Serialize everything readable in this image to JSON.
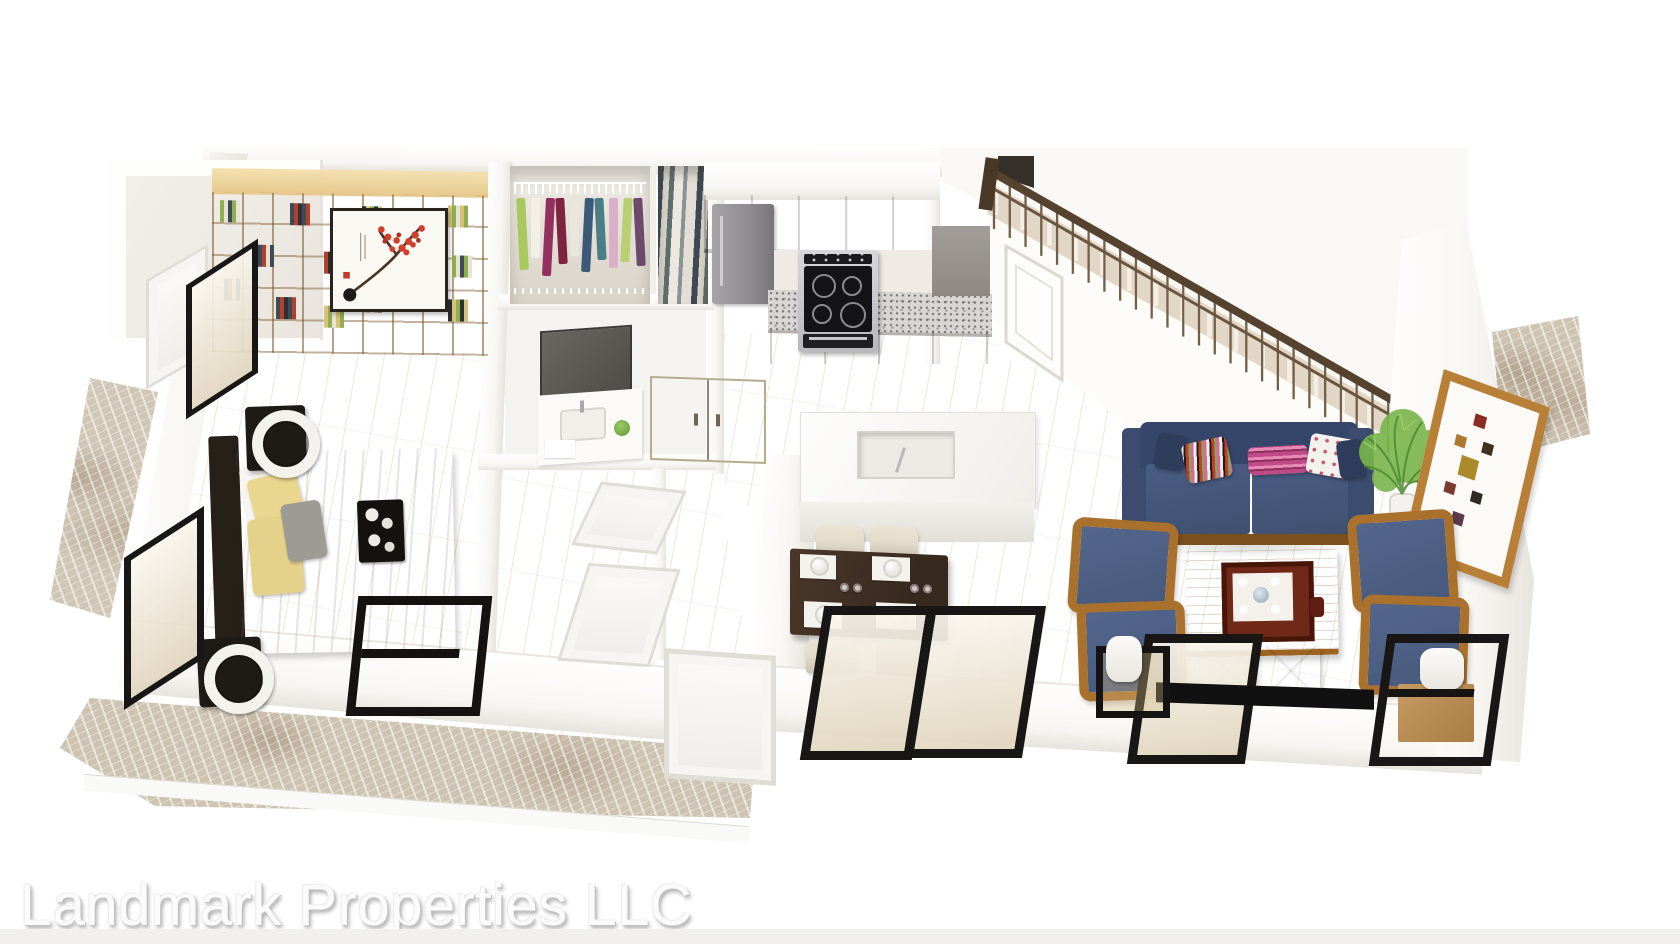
{
  "watermark": {
    "text": "Landmark Properties LLC"
  },
  "floorplan": {
    "type": "3d-floor-plan-render",
    "level": "first floor of two-story unit",
    "rooms": [
      {
        "name": "bedroom",
        "items": [
          "bookshelf wall unit",
          "framed blossom artwork",
          "platform bed",
          "nightstands",
          "ring table lamps",
          "breakfast tray",
          "black bench",
          "left wall windows"
        ]
      },
      {
        "name": "walk-in closet",
        "items": [
          "wire shelving",
          "hanging clothes"
        ]
      },
      {
        "name": "utility closet",
        "items": [
          "ironing board",
          "stored boards"
        ]
      },
      {
        "name": "bathroom",
        "items": [
          "vanity mirror",
          "sink counter",
          "cream storage cabinet"
        ]
      },
      {
        "name": "hallway",
        "items": [
          "interior doors",
          "entry door"
        ]
      },
      {
        "name": "kitchen",
        "items": [
          "refrigerator",
          "upper cabinets",
          "granite countertop",
          "range oven",
          "island with sink"
        ]
      },
      {
        "name": "dining area",
        "items": [
          "espresso dining table",
          "four place settings",
          "wine glasses",
          "cream chairs",
          "black framed windows"
        ]
      },
      {
        "name": "living room",
        "items": [
          "navy sofa",
          "throw pillows",
          "wood coffee table",
          "red serving tray",
          "white ottomans",
          "blue armchairs",
          "side tables with lamps",
          "media console",
          "potted plant",
          "gallery picture frame"
        ]
      },
      {
        "name": "staircase",
        "items": [
          "wood handrail",
          "balusters",
          "under-stair door",
          "carpeted treads"
        ]
      },
      {
        "name": "patio",
        "items": [
          "marble paving"
        ]
      }
    ],
    "hanging_clothes_colors": [
      "#a7c95e",
      "#f2efe7",
      "#93305f",
      "#7c2440",
      "#e9e6de",
      "#3c5a78",
      "#4b7d86",
      "#d9b0c8",
      "#b8cf72",
      "#6b4a6e"
    ],
    "book_spine_colors": [
      "#8fae4f",
      "#e6e2d6",
      "#3f4a52",
      "#b3402e",
      "#2c2f33",
      "#d8c27a"
    ],
    "pillow_palette": [
      "#e9d78f",
      "#9d9b94",
      "#2e3d5c",
      "#c04a86",
      "#f4f2ed"
    ],
    "colors": {
      "wall": "#f8f6f2",
      "wall_bright": "#fefefd",
      "wall_shade": "#e7e3dd",
      "wood_floor": "#ecdcb6",
      "wood_floor_light": "#f5ebd2",
      "wood_floor_deep": "#ddc99c",
      "shelf_wood": "#eacf97",
      "shelf_wood_dark": "#b98f4d",
      "marble": "#cec3b1",
      "granite": "#d8d6d2",
      "cabinet_gray": "#9b9692",
      "appliance_black": "#17171a",
      "island_white": "#fbfaf8",
      "dining_wood": "#38291f",
      "chair_cream": "#e4dccb",
      "sofa_navy": "#3f5170",
      "armchair_blue": "#47597c",
      "arm_wood": "#aa712d",
      "coffee_wood": "#c68a36",
      "tray_red": "#6f2817",
      "rail_brown": "#55422f",
      "stair_tread": "#e2d7c6",
      "door_white": "#fbfaf7",
      "closet_cream": "#e9dfc7",
      "furniture_black": "#191715",
      "plant_green": "#74b145",
      "art_red": "#cf3f2b",
      "bed_linen": "#edeae3",
      "text_fill": "#fbfbfb",
      "bottom_strip": "#f1f0ef"
    }
  }
}
